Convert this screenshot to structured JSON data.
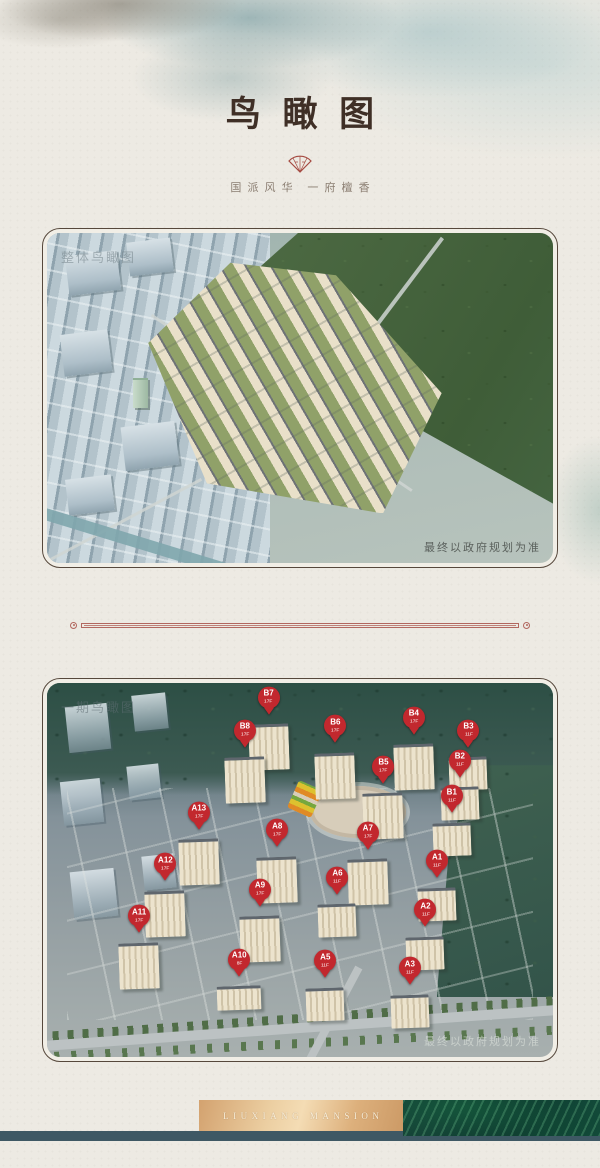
{
  "header": {
    "title": "鸟瞰图",
    "subtitle": "国派风华 一府檀香",
    "seal_icon": "fan-seal"
  },
  "overview_card": {
    "watermark": "整体鸟瞰图",
    "disclaimer": "最终以政府规划为准"
  },
  "phase_card": {
    "watermark": "一期鸟瞰图",
    "disclaimer": "最终以政府规划为准",
    "pins": [
      {
        "code": "B7",
        "floors": "17F",
        "x_pct": 43.8,
        "y_pct": 5.0
      },
      {
        "code": "B8",
        "floors": "17F",
        "x_pct": 39.1,
        "y_pct": 13.9
      },
      {
        "code": "B6",
        "floors": "17F",
        "x_pct": 57.0,
        "y_pct": 12.6
      },
      {
        "code": "B4",
        "floors": "17F",
        "x_pct": 72.5,
        "y_pct": 10.3
      },
      {
        "code": "B3",
        "floors": "11F",
        "x_pct": 83.3,
        "y_pct": 13.9
      },
      {
        "code": "B5",
        "floors": "17F",
        "x_pct": 66.5,
        "y_pct": 23.4
      },
      {
        "code": "B2",
        "floors": "11F",
        "x_pct": 81.6,
        "y_pct": 21.8
      },
      {
        "code": "B1",
        "floors": "11F",
        "x_pct": 80.0,
        "y_pct": 31.3
      },
      {
        "code": "A13",
        "floors": "17F",
        "x_pct": 30.0,
        "y_pct": 35.8
      },
      {
        "code": "A8",
        "floors": "17F",
        "x_pct": 45.5,
        "y_pct": 40.5
      },
      {
        "code": "A7",
        "floors": "17F",
        "x_pct": 63.4,
        "y_pct": 41.1
      },
      {
        "code": "A1",
        "floors": "11F",
        "x_pct": 77.1,
        "y_pct": 48.7
      },
      {
        "code": "A12",
        "floors": "17F",
        "x_pct": 23.4,
        "y_pct": 49.5
      },
      {
        "code": "A6",
        "floors": "11F",
        "x_pct": 57.4,
        "y_pct": 53.2
      },
      {
        "code": "A9",
        "floors": "17F",
        "x_pct": 42.1,
        "y_pct": 56.3
      },
      {
        "code": "A2",
        "floors": "11F",
        "x_pct": 74.8,
        "y_pct": 61.8
      },
      {
        "code": "A11",
        "floors": "17F",
        "x_pct": 18.2,
        "y_pct": 63.4
      },
      {
        "code": "A10",
        "floors": "8F",
        "x_pct": 38.0,
        "y_pct": 75.0
      },
      {
        "code": "A5",
        "floors": "11F",
        "x_pct": 55.0,
        "y_pct": 75.5
      },
      {
        "code": "A3",
        "floors": "11F",
        "x_pct": 71.7,
        "y_pct": 77.4
      }
    ]
  },
  "footer": {
    "brand": "LIUXIANG MANSION"
  },
  "colors": {
    "page_bg": "#edeae3",
    "title": "#3f2f26",
    "subtitle": "#8b7e72",
    "seal_red": "#a54a41",
    "divider": "#b2675f",
    "pin_red": "#c2282e",
    "footer_band": "#3e5864",
    "plaque_gold": "#e4bd8c",
    "feather_green": "#145040"
  }
}
